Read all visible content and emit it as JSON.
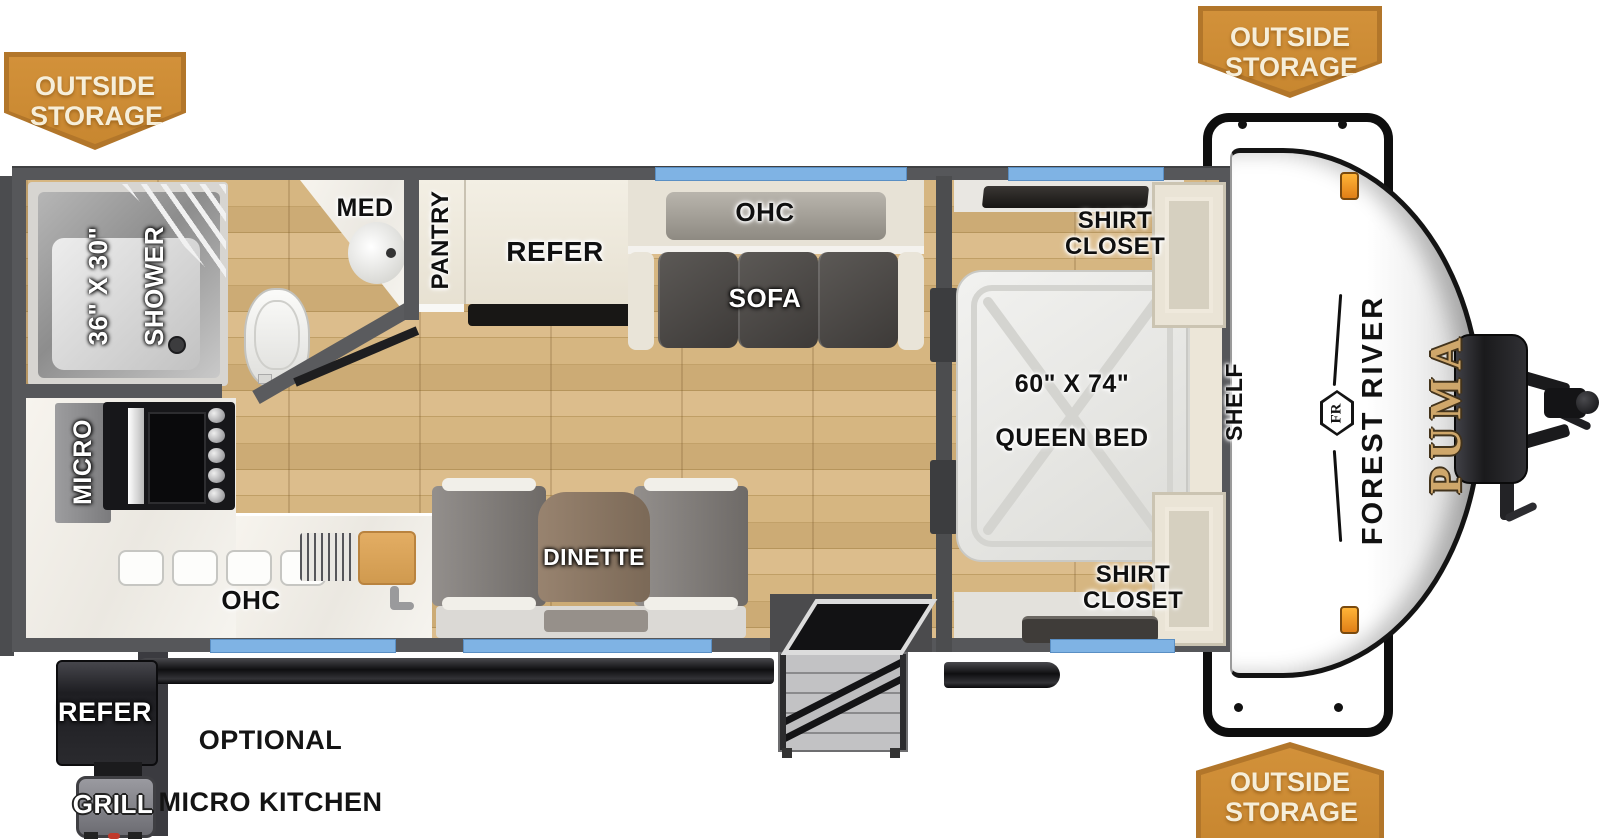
{
  "badges": {
    "top_left": "OUTSIDE STORAGE",
    "top_right": "OUTSIDE STORAGE",
    "bottom_right": "OUTSIDE STORAGE"
  },
  "brand": {
    "manufacturer": "FOREST RIVER",
    "model": "PUMA",
    "monogram": "FR"
  },
  "rooms": {
    "bathroom": {
      "shower_size": "36\" X 30\"",
      "shower": "SHOWER",
      "medicine_cabinet": "MED"
    },
    "kitchen": {
      "pantry": "PANTRY",
      "refrigerator": "REFER",
      "microwave": "MICRO",
      "overhead_cabinet": "OHC"
    },
    "living": {
      "overhead_cabinet": "OHC",
      "sofa": "SOFA",
      "dinette": "DINETTE"
    },
    "bedroom": {
      "shirt_closet_rear": "SHIRT CLOSET",
      "shirt_closet_front": "SHIRT CLOSET",
      "bed_size": "60\" X 74\"",
      "bed": "QUEEN BED",
      "shelf": "SHELF"
    },
    "exterior": {
      "refrigerator": "REFER",
      "grill": "GRILL",
      "option_line1": "OPTIONAL",
      "option_line2": "MICRO KITCHEN"
    }
  },
  "colors": {
    "badge_orange": "#CE8A33",
    "window_blue": "#7FB3E4",
    "wall_gray": "#56575A",
    "floor_wood": "#C9A770",
    "puma_gold": "#C49A5E"
  }
}
